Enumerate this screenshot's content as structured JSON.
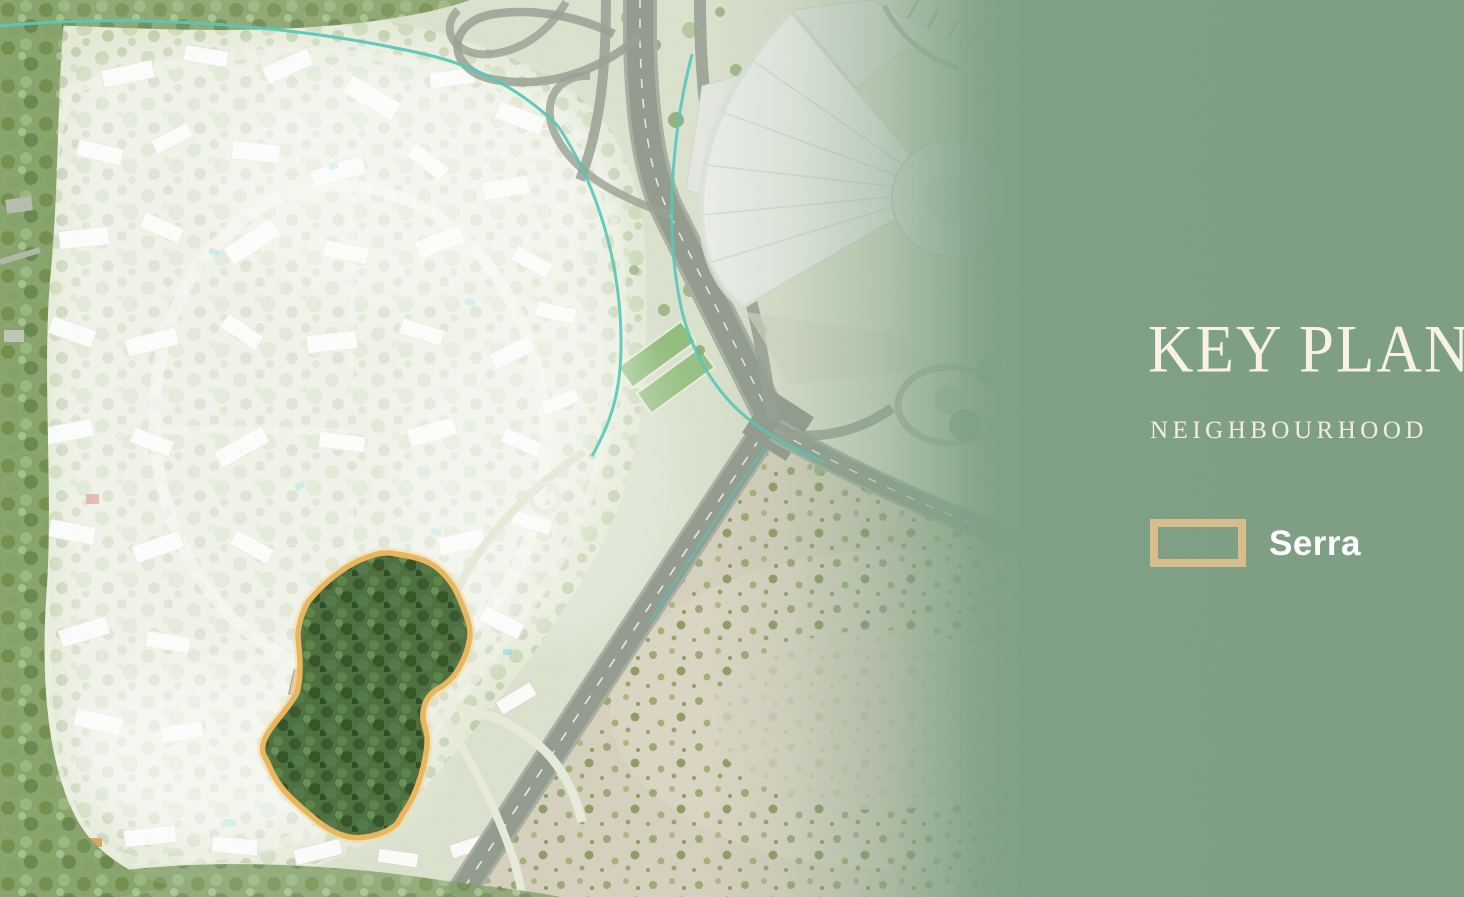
{
  "panel": {
    "title": "KEY PLAN",
    "subtitle": "NEIGHBOURHOOD",
    "background_color": "#81a287",
    "title_color": "#f7f2e6",
    "legend": [
      {
        "label": "Serra",
        "swatch_outline_color": "#d8bd8c"
      }
    ]
  },
  "map": {
    "highlighted_parcel_label": "Serra",
    "highlight_outline_color": "#ecb85f",
    "accent_line_color": "#58c9ba"
  }
}
